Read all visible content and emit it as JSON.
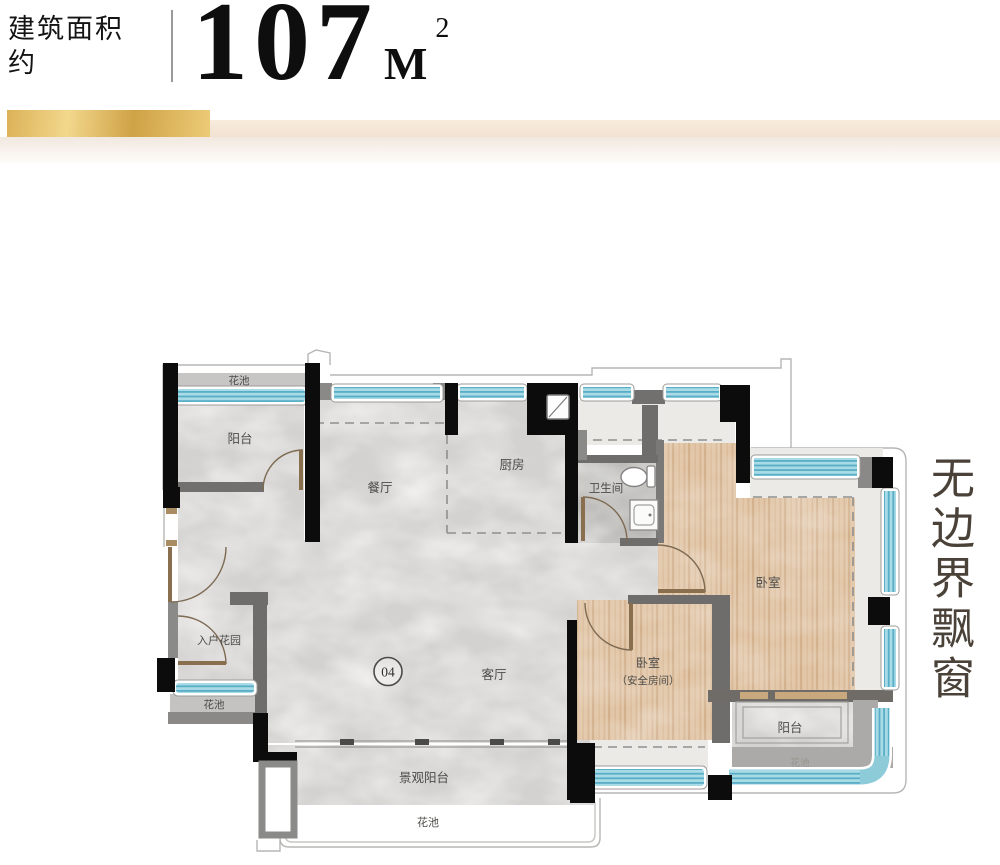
{
  "header": {
    "area_label": "建筑面积",
    "area_label2": "约",
    "area_value": "107",
    "area_unit": "M",
    "area_sup": "2"
  },
  "side_note": "无边界飘窗",
  "floorplan": {
    "unit_number": "04",
    "rooms": {
      "flower_bed_top": "花池",
      "balcony_top_left": "阳台",
      "dining": "餐厅",
      "kitchen": "厨房",
      "bathroom": "卫生间",
      "bedroom_right": "卧室",
      "entry_garden": "入户花园",
      "flower_bed_left": "花池",
      "living": "客厅",
      "bedroom_safe_name": "卧室",
      "bedroom_safe_note": "（安全房间）",
      "landscape_balcony": "景观阳台",
      "flower_bed_bottom": "花池",
      "balcony_bottom_right": "阳台",
      "flower_bed_bottom_right": "花池"
    },
    "colors": {
      "window_blue": "#8ecbd9",
      "wood": "#e2c6a7",
      "marble": "#d3d2d0",
      "wall_black": "#0c0c0c",
      "gold": "#d9ae52"
    }
  }
}
